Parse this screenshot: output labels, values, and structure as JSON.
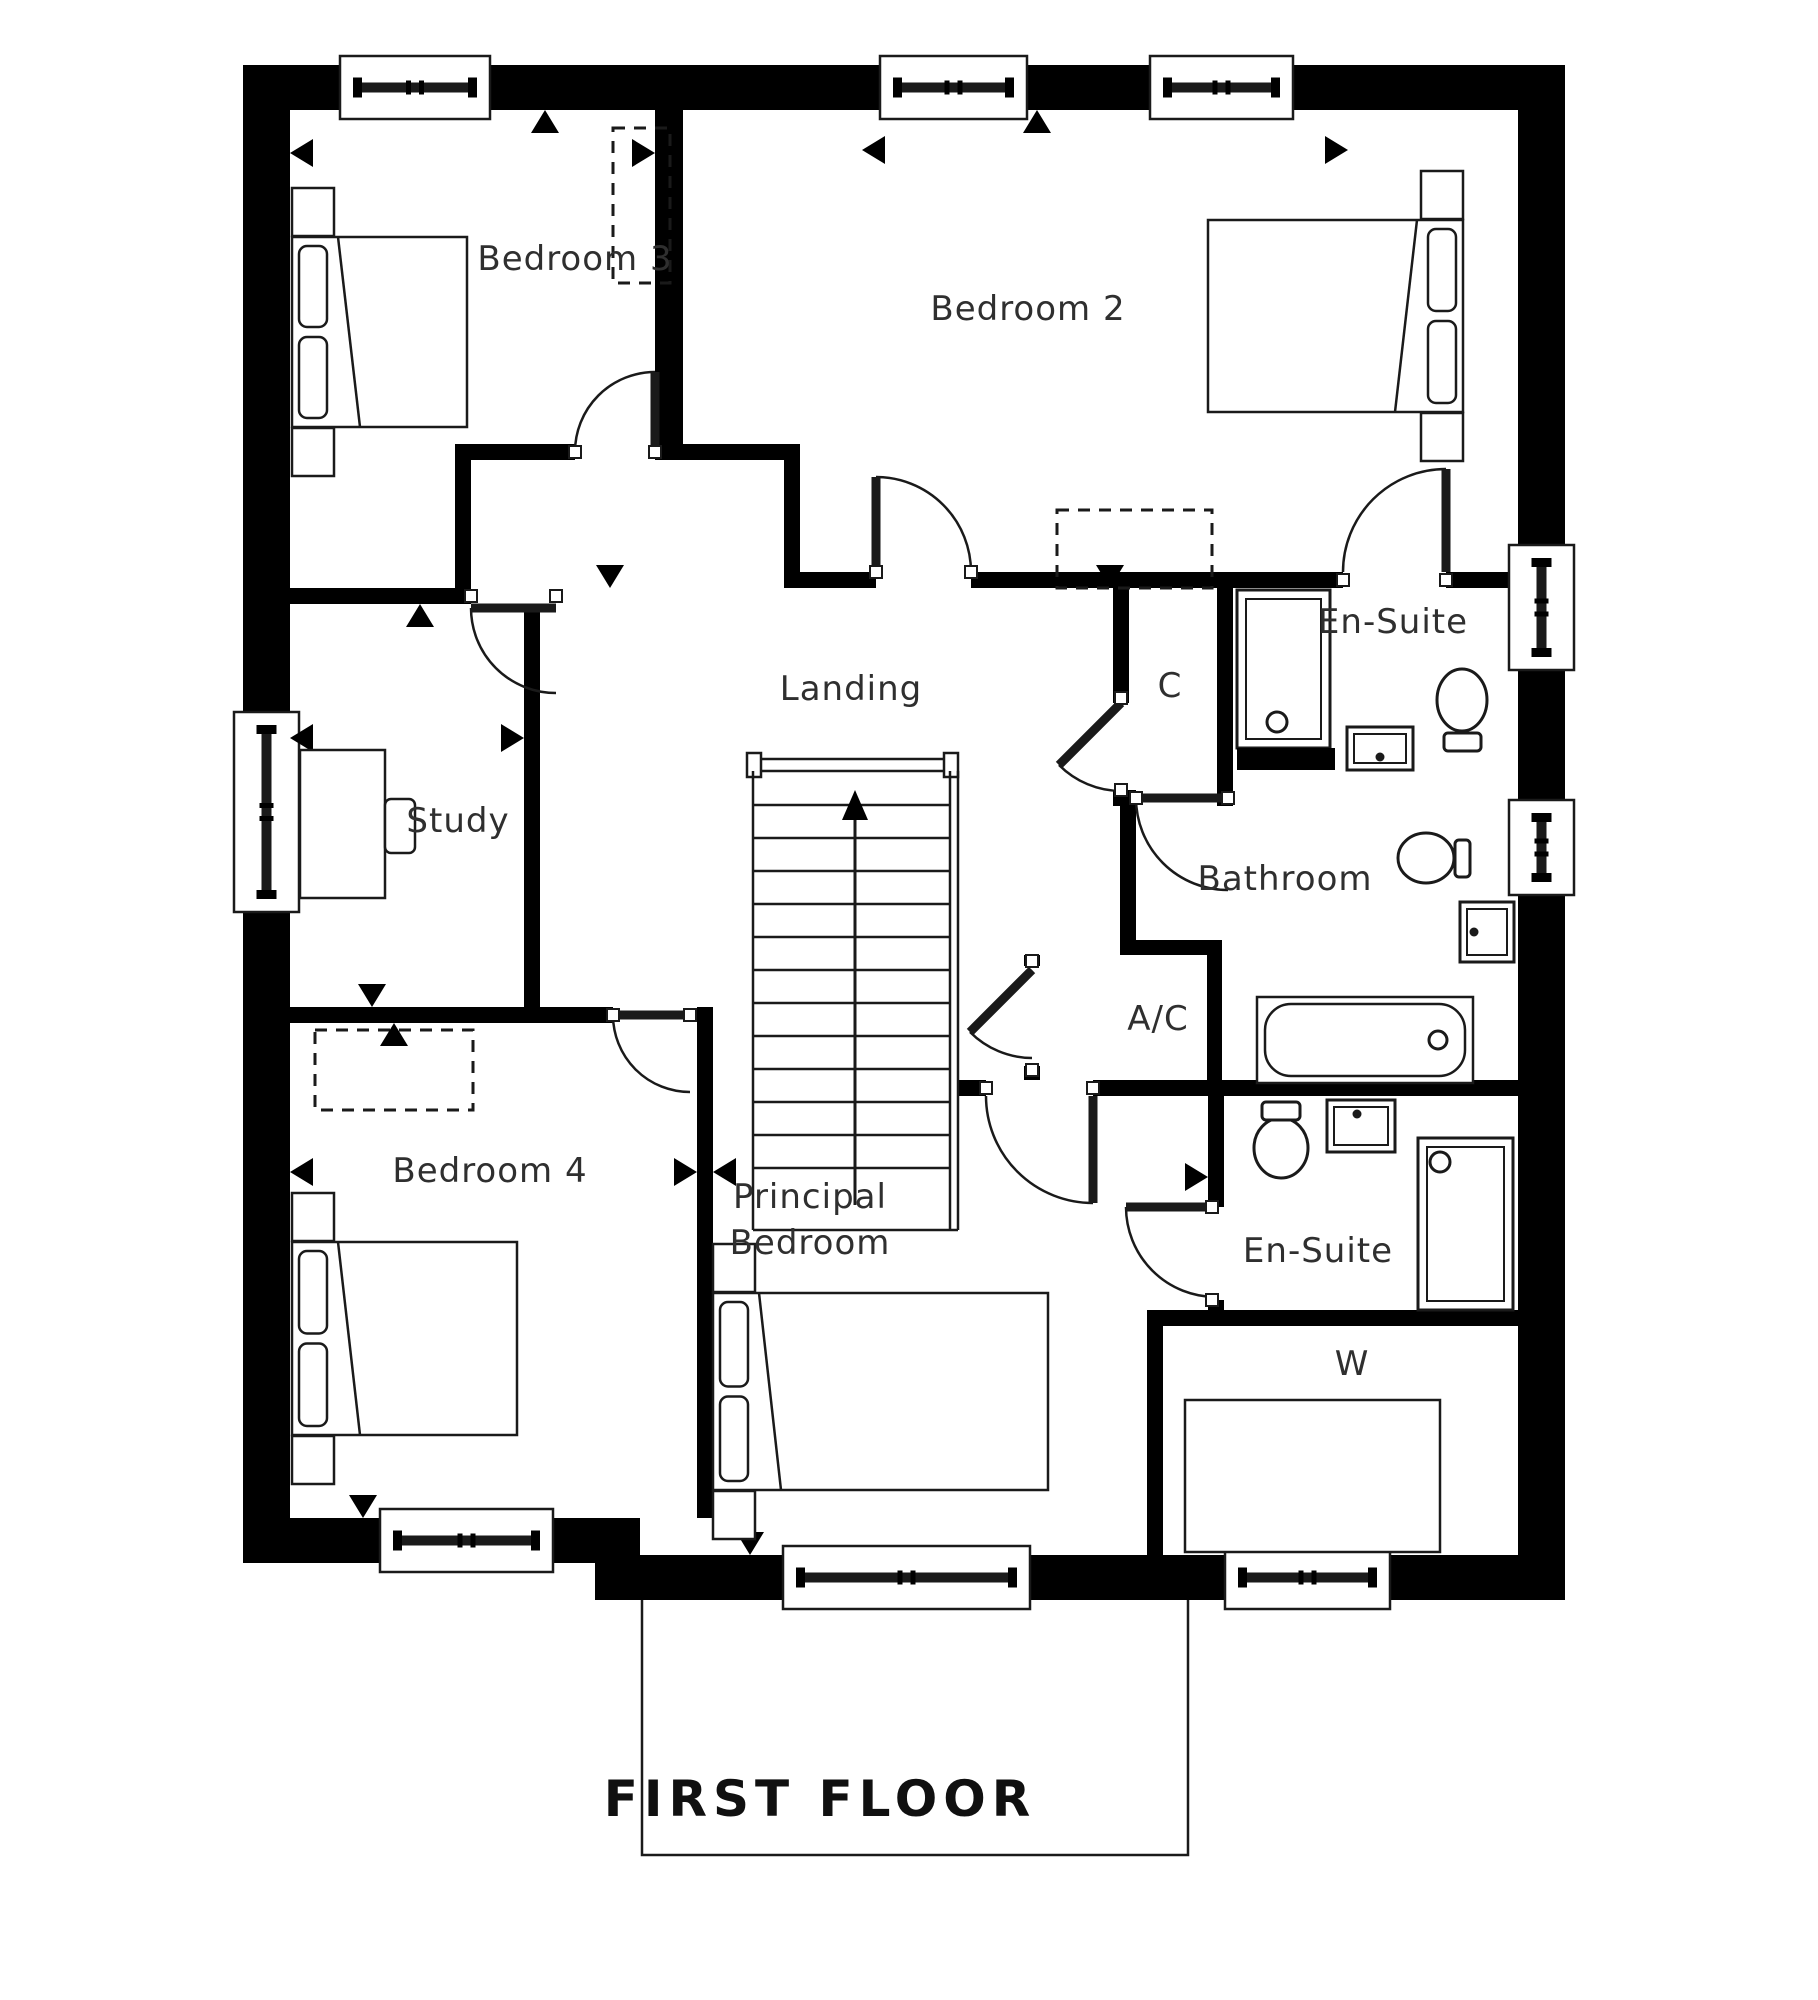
{
  "title": {
    "text": "FIRST FLOOR"
  },
  "floor_plan": {
    "labels": [
      {
        "id": "bedroom-3",
        "text": "Bedroom 3",
        "x": 575,
        "y": 270
      },
      {
        "id": "bedroom-2",
        "text": "Bedroom 2",
        "x": 1028,
        "y": 320
      },
      {
        "id": "en-suite-1",
        "text": "En-Suite",
        "x": 1393,
        "y": 633
      },
      {
        "id": "closet-c",
        "text": "C",
        "x": 1170,
        "y": 697
      },
      {
        "id": "landing",
        "text": "Landing",
        "x": 851,
        "y": 700
      },
      {
        "id": "study",
        "text": "Study",
        "x": 458,
        "y": 832
      },
      {
        "id": "bathroom",
        "text": "Bathroom",
        "x": 1285,
        "y": 890
      },
      {
        "id": "ac-cupboard",
        "text": "A/C",
        "x": 1158,
        "y": 1030
      },
      {
        "id": "bedroom-4",
        "text": "Bedroom 4",
        "x": 490,
        "y": 1182
      },
      {
        "id": "principal-bedroom",
        "text": "Principal Bedroom",
        "lines": [
          "Principal",
          "Bedroom"
        ],
        "x": 810,
        "y": 1208,
        "line_height": 46
      },
      {
        "id": "en-suite-2",
        "text": "En-Suite",
        "x": 1318,
        "y": 1262
      },
      {
        "id": "wardrobe-w",
        "text": "W",
        "x": 1352,
        "y": 1375
      }
    ],
    "stairs_direction": "up"
  },
  "colors": {
    "wall": "#000000",
    "line": "#1a1a1a",
    "text": "#2f2f2f",
    "background": "#ffffff"
  }
}
